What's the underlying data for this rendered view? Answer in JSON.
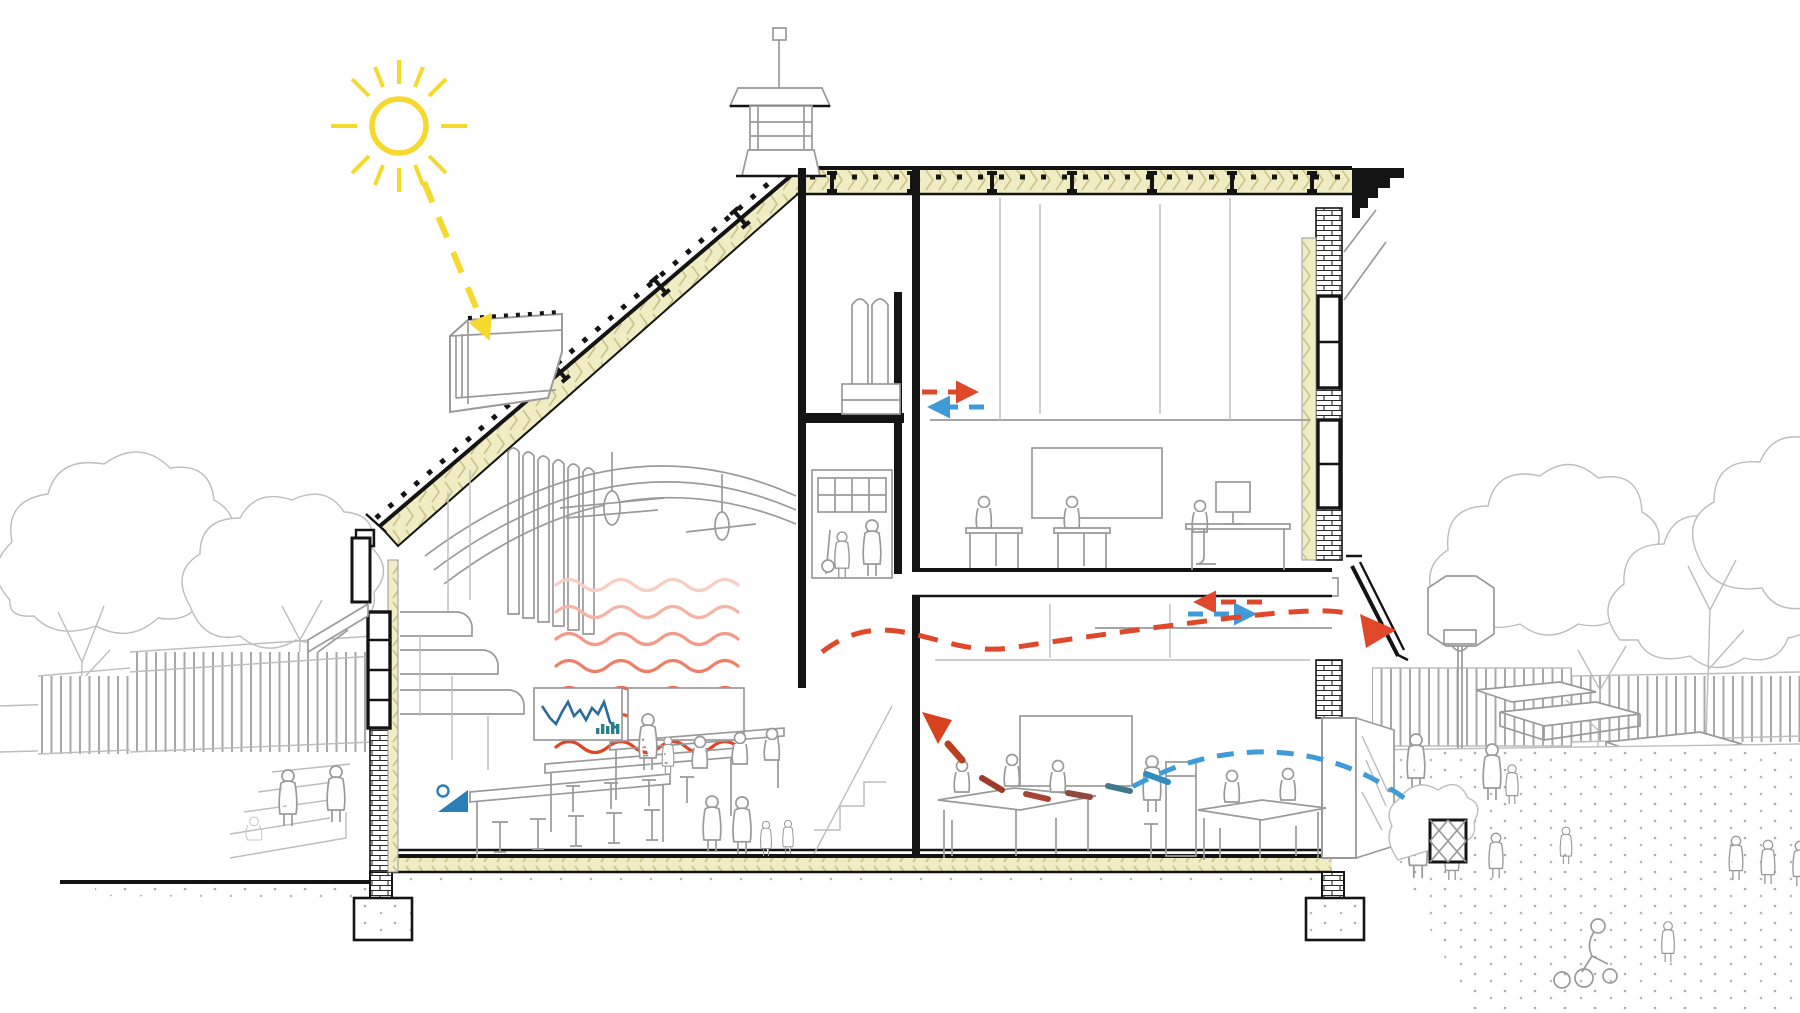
{
  "diagram": {
    "kind": "architectural cross-section of a school building with passive environmental strategy annotations",
    "visible_text": "",
    "icons": [
      {
        "name": "sun-icon",
        "color": "#f5d92e"
      },
      {
        "name": "solar-gain-ray-arrow",
        "color": "#f5d92e"
      },
      {
        "name": "heat-wave-lines",
        "colors": [
          "#f8cdc2",
          "#e34424"
        ]
      },
      {
        "name": "warm-air-dashed-arrow",
        "color": "#e0482b"
      },
      {
        "name": "cool-air-dashed-arrow",
        "color": "#3e9bd8"
      },
      {
        "name": "rising-warm-air-arrow",
        "color": "#d9421f"
      },
      {
        "name": "exhaust-air-arrow",
        "color": "#e0482b"
      },
      {
        "name": "cool-intake-dashed-path",
        "color": "#3e9bd8"
      },
      {
        "name": "warm-extract-dashed-path",
        "color": "#e0482b"
      },
      {
        "name": "mixing-air-dashes",
        "colors": [
          "#9e3b28",
          "#2e8fbf"
        ]
      },
      {
        "name": "sensor-wedge-icon",
        "color": "#2b7fb9"
      },
      {
        "name": "whiteboard-line-chart-icon",
        "color": "#2a6d9c"
      },
      {
        "name": "whiteboard-bar-chart-icon",
        "color": "#27818a"
      },
      {
        "name": "ceiling-fan-icon",
        "color": "#9a9a9a"
      },
      {
        "name": "roof-joist-icon",
        "color": "#141414"
      },
      {
        "name": "basketball-hoop-icon",
        "color": "#9a9a9a"
      }
    ]
  },
  "palette": {
    "sun": "#f5d92e",
    "warm": "#e0482b",
    "warm_dark": "#a03e26",
    "cool": "#3e9bd8",
    "insulation": "#f0ecc4",
    "insulation_hatch": "#cbc28a",
    "line_dark": "#141414",
    "line_gray": "#9a9a9a",
    "line_faint": "#bdbdbd",
    "chart_line": "#2a6d9c",
    "chart_bars": "#27818a",
    "sensor": "#2b7fb9",
    "heat_waves": [
      "#f8cdc2",
      "#f5b4a4",
      "#f29a85",
      "#ee8067",
      "#ea674b",
      "#e65032",
      "#e34424"
    ],
    "mix_dashes": [
      "#9e3b28",
      "#a44434",
      "#8f4a3c",
      "#7a5048",
      "#41788c",
      "#2e8fbf"
    ]
  }
}
